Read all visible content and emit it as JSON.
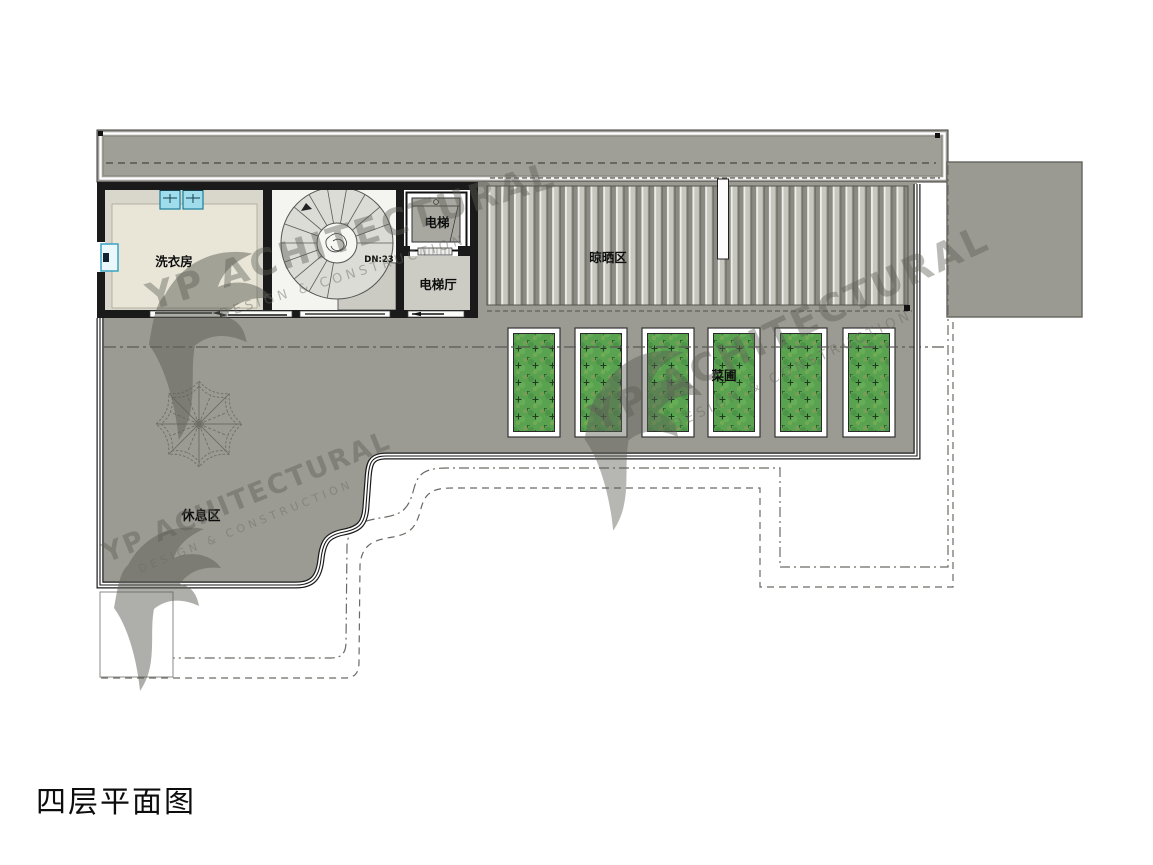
{
  "title": {
    "label": "四层平面图"
  },
  "labels": {
    "laundry_room": "洗衣房",
    "elevator": "电梯",
    "elevator_hall": "电梯厅",
    "stair_direction": "DN:23",
    "drying_area": "晾晒区",
    "vegetable_garden": "菜圃",
    "rest_area": "休息区"
  },
  "watermark": {
    "brand": "YP ACHITECTURAL",
    "tagline": "DESIGN & CONSTRUCTION"
  },
  "colors": {
    "roof_band_gray": "#a09f97",
    "terrace_gray": "#9b9b93",
    "extension_gray": "#9a9a92",
    "slat_dark": "#8b8b83",
    "slat_light": "#c7c7bf",
    "laundry_floor": "#e9e6d7",
    "hall_floor": "#ccccc4",
    "stair_fill": "#dcdcd6",
    "planter_green": "#58a250",
    "washer_cyan": "#9fdcec",
    "wall_black": "#1a1a1a"
  }
}
